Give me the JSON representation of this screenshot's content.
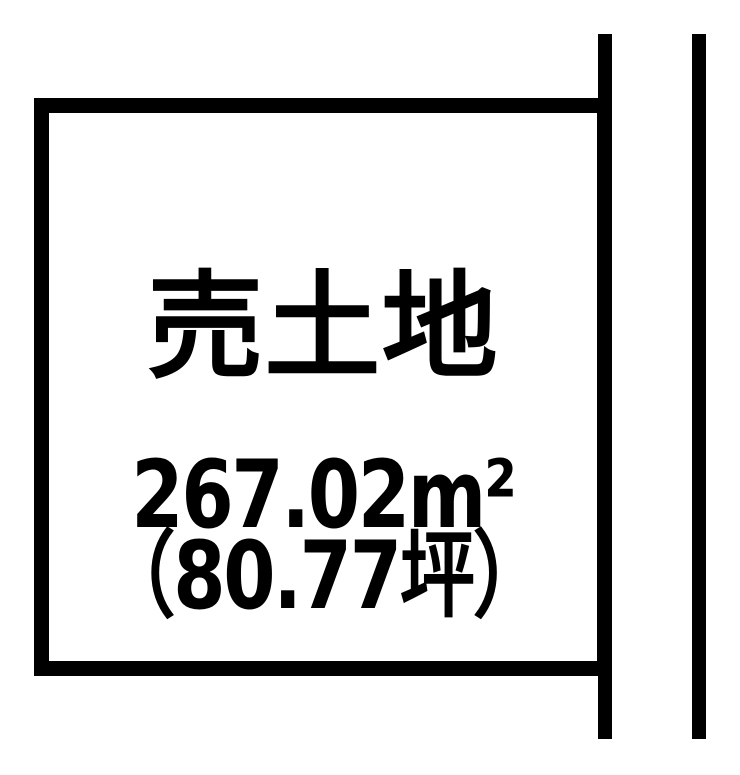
{
  "diagram": {
    "type": "land-plot",
    "title": "売土地",
    "area_sqm": "267.02m²",
    "area_tsubo": "（80.77坪）",
    "colors": {
      "line": "#000000",
      "background": "#ffffff",
      "text": "#000000"
    }
  }
}
